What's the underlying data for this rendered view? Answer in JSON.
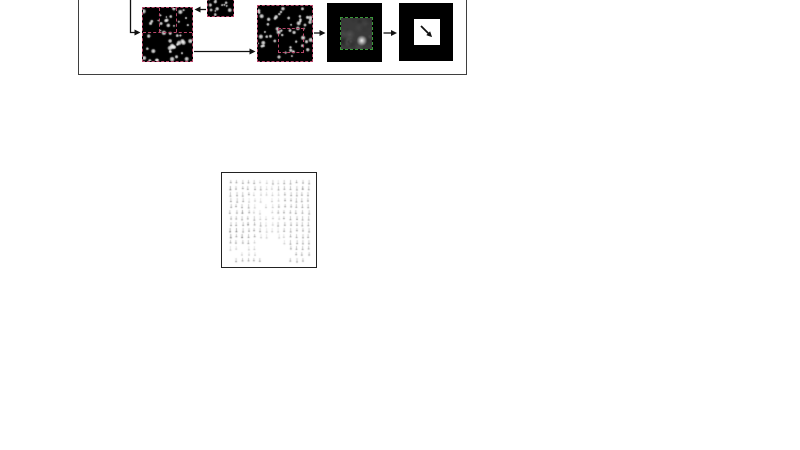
{
  "page": {
    "background": "#ffffff"
  },
  "diagram": {
    "name": "piv-cross-correlation-pipeline",
    "colors": {
      "frame_border": "#3f3f3f",
      "arrow": "#111111",
      "interrogation_window": "#b8476a",
      "correlation_peak_window": "#3a9a3a",
      "image_background": "#000000",
      "vector_box_border": "#222222"
    },
    "nodes": {
      "image_a": {
        "label": "particle-image-frame-a",
        "seed": 7,
        "dots": 46
      },
      "template": {
        "label": "interrogation-template-window",
        "seed": 13,
        "dots": 13
      },
      "image_b": {
        "label": "particle-image-frame-b",
        "seed": 21,
        "dots": 52
      },
      "correlation": {
        "label": "correlation-map",
        "seed": 5,
        "peak_x": 0.67,
        "peak_y": 0.73
      },
      "result": {
        "label": "displacement-vector"
      }
    }
  },
  "quiver": {
    "label": "velocity-vector-field",
    "cols": 14,
    "rows": 14,
    "spacing": 6,
    "seed": 3,
    "mark_color_rgb": [
      90,
      90,
      90
    ],
    "grid": [
      [
        2,
        2,
        2,
        2,
        2,
        1,
        1,
        2,
        1,
        2,
        2,
        2,
        2,
        2
      ],
      [
        3,
        2,
        2,
        2,
        2,
        2,
        1,
        1,
        2,
        2,
        2,
        2,
        3,
        2
      ],
      [
        2,
        2,
        2,
        2,
        1,
        1,
        1,
        1,
        1,
        2,
        2,
        2,
        2,
        2
      ],
      [
        2,
        2,
        2,
        1,
        1,
        1,
        0,
        1,
        1,
        2,
        2,
        2,
        2,
        2
      ],
      [
        2,
        2,
        2,
        2,
        1,
        0,
        1,
        1,
        2,
        2,
        2,
        2,
        2,
        2
      ],
      [
        2,
        2,
        3,
        2,
        1,
        1,
        0,
        1,
        2,
        2,
        2,
        2,
        2,
        2
      ],
      [
        2,
        2,
        2,
        2,
        2,
        1,
        1,
        1,
        1,
        2,
        2,
        2,
        2,
        2
      ],
      [
        2,
        2,
        2,
        3,
        2,
        2,
        1,
        1,
        2,
        2,
        2,
        2,
        2,
        2
      ],
      [
        3,
        3,
        2,
        2,
        2,
        2,
        1,
        1,
        1,
        2,
        2,
        2,
        2,
        2
      ],
      [
        3,
        2,
        3,
        2,
        2,
        1,
        1,
        0,
        1,
        1,
        2,
        2,
        2,
        2
      ],
      [
        2,
        2,
        2,
        2,
        1,
        0,
        0,
        0,
        0,
        1,
        2,
        2,
        2,
        2
      ],
      [
        1,
        1,
        0,
        1,
        1,
        0,
        0,
        0,
        0,
        0,
        2,
        2,
        2,
        2
      ],
      [
        0,
        0,
        1,
        1,
        1,
        0,
        0,
        0,
        0,
        0,
        0,
        2,
        2,
        2
      ],
      [
        0,
        2,
        2,
        2,
        2,
        2,
        0,
        0,
        0,
        0,
        2,
        2,
        2,
        0
      ]
    ]
  }
}
